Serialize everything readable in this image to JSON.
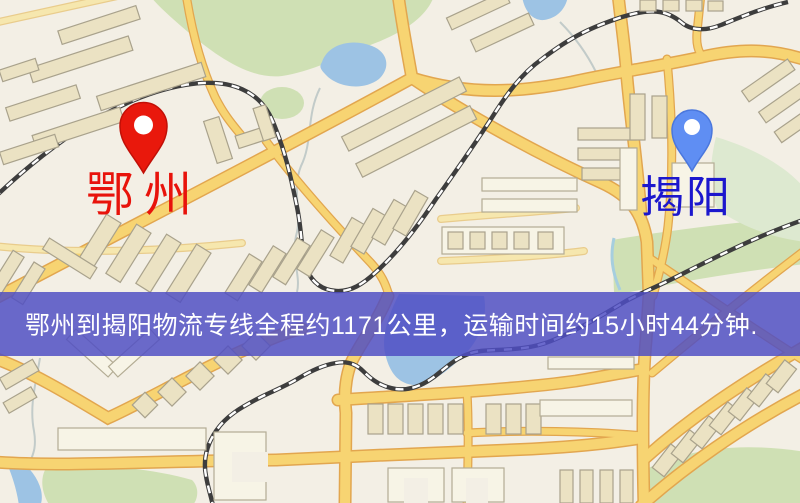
{
  "map": {
    "origin_marker": {
      "label": "鄂州",
      "pin_color": "#e9180c",
      "label_color": "#e8130b"
    },
    "destination_marker": {
      "label": "揭阳",
      "pin_color": "#5f8ef3",
      "label_color": "#1c17cd"
    },
    "banner": {
      "text": "鄂州到揭阳物流专线全程约1171公里，运输时间约15小时44分钟.",
      "background_color": "#4f4dc4",
      "text_color": "#ffffff",
      "distance_km": "1171",
      "duration": "15小时44分钟"
    }
  }
}
